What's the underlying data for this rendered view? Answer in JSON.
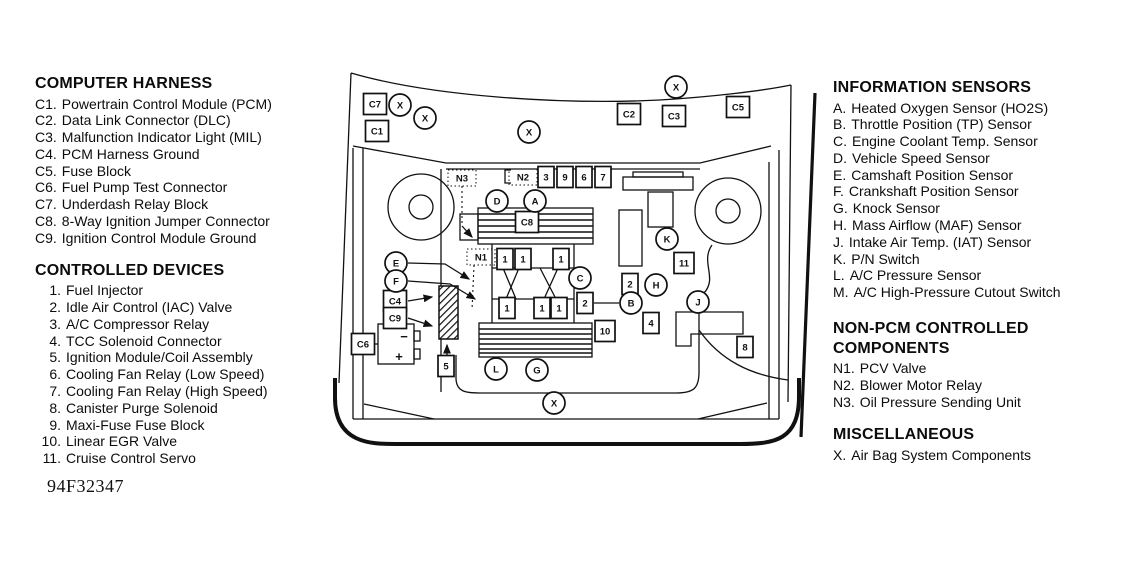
{
  "figure_code": "94F32347",
  "legend_left": {
    "computer_harness": {
      "title": "COMPUTER HARNESS",
      "items": [
        {
          "num": "C1.",
          "label": "Powertrain Control Module (PCM)"
        },
        {
          "num": "C2.",
          "label": "Data Link Connector (DLC)"
        },
        {
          "num": "C3.",
          "label": "Malfunction Indicator Light (MIL)"
        },
        {
          "num": "C4.",
          "label": "PCM Harness Ground"
        },
        {
          "num": "C5.",
          "label": "Fuse Block"
        },
        {
          "num": "C6.",
          "label": "Fuel Pump Test Connector"
        },
        {
          "num": "C7.",
          "label": "Underdash Relay Block"
        },
        {
          "num": "C8.",
          "label": "8-Way Ignition Jumper Connector"
        },
        {
          "num": "C9.",
          "label": "Ignition Control Module Ground"
        }
      ]
    },
    "controlled_devices": {
      "title": "CONTROLLED DEVICES",
      "items": [
        {
          "num": "1.",
          "label": "Fuel Injector"
        },
        {
          "num": "2.",
          "label": "Idle Air Control (IAC) Valve"
        },
        {
          "num": "3.",
          "label": "A/C Compressor Relay"
        },
        {
          "num": "4.",
          "label": "TCC Solenoid Connector"
        },
        {
          "num": "5.",
          "label": "Ignition Module/Coil Assembly"
        },
        {
          "num": "6.",
          "label": "Cooling Fan Relay (Low Speed)"
        },
        {
          "num": "7.",
          "label": "Cooling Fan Relay (High Speed)"
        },
        {
          "num": "8.",
          "label": "Canister Purge Solenoid"
        },
        {
          "num": "9.",
          "label": "Maxi-Fuse Fuse Block"
        },
        {
          "num": "10.",
          "label": "Linear EGR Valve"
        },
        {
          "num": "11.",
          "label": "Cruise Control Servo"
        }
      ]
    }
  },
  "legend_right": {
    "information_sensors": {
      "title": "INFORMATION SENSORS",
      "items": [
        {
          "num": "A.",
          "label": "Heated Oxygen Sensor (HO2S)"
        },
        {
          "num": "B.",
          "label": "Throttle Position (TP) Sensor"
        },
        {
          "num": "C.",
          "label": "Engine Coolant Temp. Sensor"
        },
        {
          "num": "D.",
          "label": "Vehicle Speed Sensor"
        },
        {
          "num": "E.",
          "label": "Camshaft Position Sensor"
        },
        {
          "num": "F.",
          "label": "Crankshaft Position Sensor"
        },
        {
          "num": "G.",
          "label": "Knock Sensor"
        },
        {
          "num": "H.",
          "label": "Mass Airflow (MAF) Sensor"
        },
        {
          "num": "J.",
          "label": "Intake Air Temp. (IAT) Sensor"
        },
        {
          "num": "K.",
          "label": "P/N Switch"
        },
        {
          "num": "L.",
          "label": "A/C Pressure Sensor"
        },
        {
          "num": "M.",
          "label": "A/C High-Pressure Cutout Switch"
        }
      ]
    },
    "non_pcm": {
      "title_line1": "NON-PCM CONTROLLED",
      "title_line2": "COMPONENTS",
      "items": [
        {
          "num": "N1.",
          "label": "PCV Valve"
        },
        {
          "num": "N2.",
          "label": "Blower Motor Relay"
        },
        {
          "num": "N3.",
          "label": "Oil Pressure Sending Unit"
        }
      ]
    },
    "miscellaneous": {
      "title": "MISCELLANEOUS",
      "items": [
        {
          "num": "X.",
          "label": "Air Bag System Components"
        }
      ]
    }
  },
  "diagram": {
    "battery": {
      "minus": "−",
      "plus": "+"
    },
    "callouts": [
      {
        "shape": "square",
        "label": "C7",
        "x": 375,
        "y": 104
      },
      {
        "shape": "square",
        "label": "C1",
        "x": 377,
        "y": 131
      },
      {
        "shape": "square",
        "label": "C2",
        "x": 629,
        "y": 114
      },
      {
        "shape": "square",
        "label": "C3",
        "x": 674,
        "y": 116
      },
      {
        "shape": "square",
        "label": "C5",
        "x": 738,
        "y": 107
      },
      {
        "shape": "square",
        "label": "C8",
        "x": 527,
        "y": 222
      },
      {
        "shape": "square",
        "label": "C4",
        "x": 395,
        "y": 301
      },
      {
        "shape": "square",
        "label": "C9",
        "x": 395,
        "y": 318
      },
      {
        "shape": "square",
        "label": "C6",
        "x": 363,
        "y": 344
      },
      {
        "shape": "square",
        "label": "3",
        "x": 546,
        "y": 177,
        "w": 16
      },
      {
        "shape": "square",
        "label": "9",
        "x": 565,
        "y": 177,
        "w": 16
      },
      {
        "shape": "square",
        "label": "6",
        "x": 584,
        "y": 177,
        "w": 16
      },
      {
        "shape": "square",
        "label": "7",
        "x": 603,
        "y": 177,
        "w": 16
      },
      {
        "shape": "square",
        "label": "1",
        "x": 505,
        "y": 259,
        "w": 16
      },
      {
        "shape": "square",
        "label": "1",
        "x": 523,
        "y": 259,
        "w": 16
      },
      {
        "shape": "square",
        "label": "1",
        "x": 561,
        "y": 259,
        "w": 16
      },
      {
        "shape": "square",
        "label": "1",
        "x": 507,
        "y": 308,
        "w": 16
      },
      {
        "shape": "square",
        "label": "1",
        "x": 542,
        "y": 308,
        "w": 16
      },
      {
        "shape": "square",
        "label": "1",
        "x": 559,
        "y": 308,
        "w": 16
      },
      {
        "shape": "square",
        "label": "2",
        "x": 630,
        "y": 284,
        "w": 16
      },
      {
        "shape": "square",
        "label": "2",
        "x": 585,
        "y": 303,
        "w": 16
      },
      {
        "shape": "square",
        "label": "10",
        "x": 605,
        "y": 331,
        "w": 20
      },
      {
        "shape": "square",
        "label": "4",
        "x": 651,
        "y": 323,
        "w": 16
      },
      {
        "shape": "square",
        "label": "11",
        "x": 684,
        "y": 263,
        "w": 20
      },
      {
        "shape": "square",
        "label": "8",
        "x": 745,
        "y": 347,
        "w": 16
      },
      {
        "shape": "square",
        "label": "5",
        "x": 446,
        "y": 366,
        "w": 16
      },
      {
        "shape": "circle",
        "label": "X",
        "x": 400,
        "y": 105
      },
      {
        "shape": "circle",
        "label": "X",
        "x": 425,
        "y": 118
      },
      {
        "shape": "circle",
        "label": "X",
        "x": 529,
        "y": 132
      },
      {
        "shape": "circle",
        "label": "X",
        "x": 676,
        "y": 87
      },
      {
        "shape": "circle",
        "label": "X",
        "x": 554,
        "y": 403
      },
      {
        "shape": "circle",
        "label": "D",
        "x": 497,
        "y": 201
      },
      {
        "shape": "circle",
        "label": "A",
        "x": 535,
        "y": 201
      },
      {
        "shape": "circle",
        "label": "E",
        "x": 396,
        "y": 263
      },
      {
        "shape": "circle",
        "label": "F",
        "x": 396,
        "y": 281
      },
      {
        "shape": "circle",
        "label": "K",
        "x": 667,
        "y": 239
      },
      {
        "shape": "circle",
        "label": "C",
        "x": 580,
        "y": 278
      },
      {
        "shape": "circle",
        "label": "H",
        "x": 656,
        "y": 285
      },
      {
        "shape": "circle",
        "label": "B",
        "x": 631,
        "y": 303
      },
      {
        "shape": "circle",
        "label": "J",
        "x": 698,
        "y": 302
      },
      {
        "shape": "circle",
        "label": "L",
        "x": 496,
        "y": 369
      },
      {
        "shape": "circle",
        "label": "G",
        "x": 537,
        "y": 370
      },
      {
        "shape": "label",
        "label": "N3",
        "x": 462,
        "y": 178
      },
      {
        "shape": "label",
        "label": "N2",
        "x": 523,
        "y": 177
      },
      {
        "shape": "label",
        "label": "N1",
        "x": 481,
        "y": 257
      }
    ]
  }
}
